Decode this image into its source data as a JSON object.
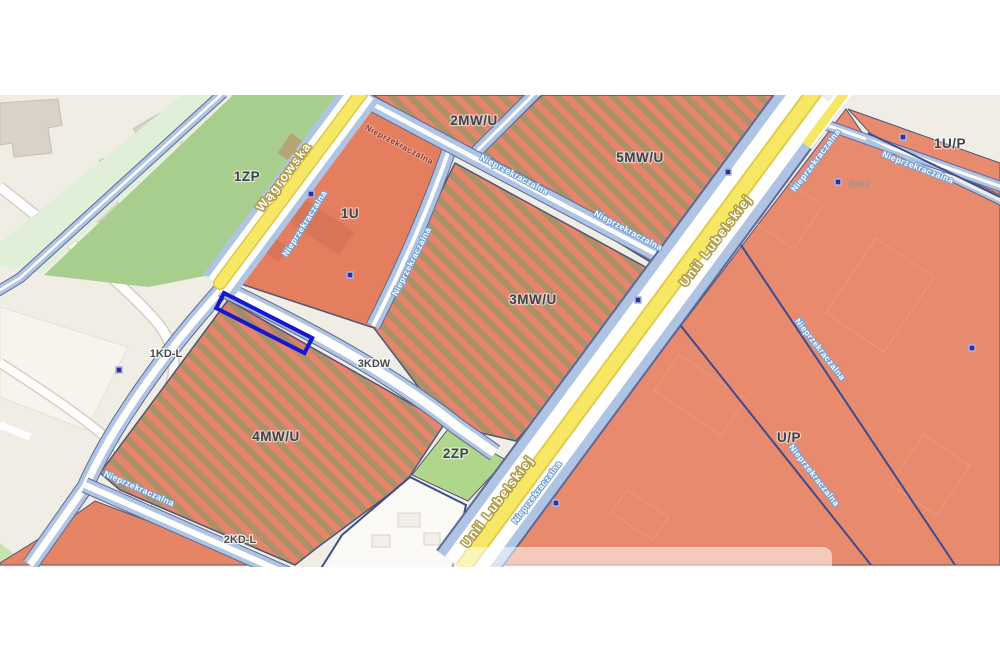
{
  "map": {
    "zones": {
      "z1zp": "1ZP",
      "z2zp": "2ZP",
      "z1u": "1U",
      "z2mwu": "2MW/U",
      "z3mwu": "3MW/U",
      "z4mwu": "4MW/U",
      "z5mwu": "5MW/U",
      "zup": "U/P",
      "z1up": "1U/P"
    },
    "roads": {
      "r1kdl": "1KD-L",
      "r2kdl": "2KD-L",
      "r3kdw": "3KDW"
    },
    "streets": {
      "wagrowska": "Wągrowska",
      "unii_lubelskiej": "Unii Lubelskiej"
    },
    "building_line_label": "Nieprzekraczalna",
    "place_label": "dwor",
    "colors": {
      "land": "#F0EDE5",
      "zone_salmon": "#E8836A",
      "zone_stripe_brown": "#AB9168",
      "green_zp": "#A8CE8E",
      "green_pale": "#DFEFD8",
      "road_blue": "#AFC4E3",
      "road_yellow": "#F6E865",
      "boundary_navy": "#3F4B8C",
      "selection_blue": "#1518CE",
      "marker_purple": "#3D2C8E",
      "building_gray": "#D9D2C8"
    }
  }
}
